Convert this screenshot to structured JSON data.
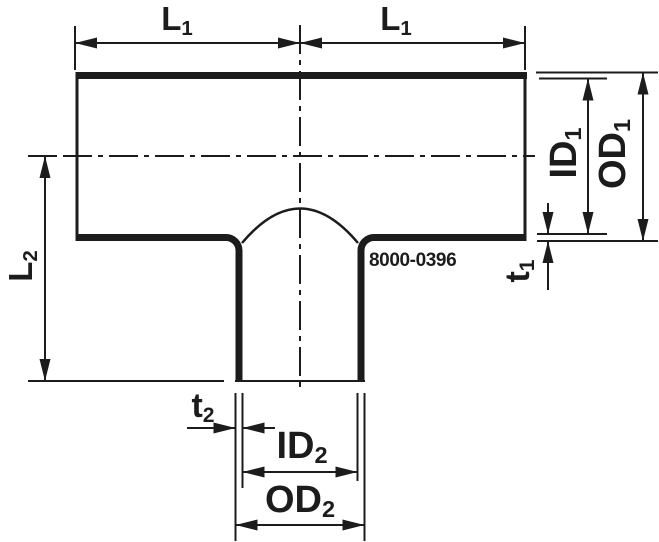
{
  "drawing": {
    "part_number": "8000-0396",
    "colors": {
      "ink": "#1c1c1c",
      "background": "#ffffff"
    },
    "dimension_labels": {
      "l1_left": {
        "main": "L",
        "sub": "1"
      },
      "l1_right": {
        "main": "L",
        "sub": "1"
      },
      "l2": {
        "main": "L",
        "sub": "2"
      },
      "id1": {
        "main": "ID",
        "sub": "1"
      },
      "od1": {
        "main": "OD",
        "sub": "1"
      },
      "t1": {
        "main": "t",
        "sub": "1"
      },
      "id2": {
        "main": "ID",
        "sub": "2"
      },
      "od2": {
        "main": "OD",
        "sub": "2"
      },
      "t2": {
        "main": "t",
        "sub": "2"
      }
    }
  }
}
